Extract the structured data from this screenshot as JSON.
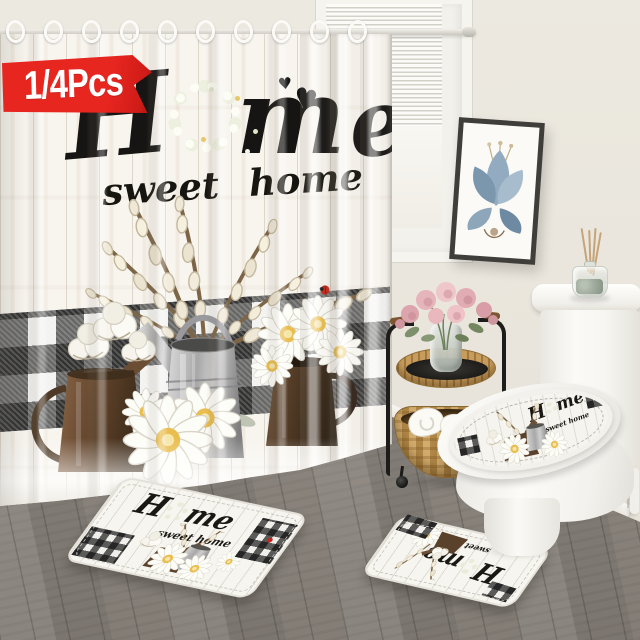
{
  "badge": {
    "label": "1/4Pcs"
  },
  "curtain": {
    "letter_h": "H",
    "letter_m": "m",
    "letter_e": "e",
    "heart": "♥",
    "subtitle_word1": "sweet",
    "subtitle_word2": "home"
  },
  "bath_mat": {
    "word_start": "H",
    "word_end": "me",
    "subtitle": "sweet home"
  },
  "contour_mat": {
    "word_start": "H",
    "word_end": "me",
    "subtitle": "sweet home"
  },
  "lid_cover": {
    "word_start": "H",
    "word_end": "me",
    "subtitle": "sweet home"
  },
  "colors": {
    "badge_red": "#e82620",
    "wall": "#e9e5dc",
    "floor_gray": "#8f8983",
    "plaid_black": "#161616",
    "curtain_white": "#f8f5ef",
    "wicker_tan": "#c59a55",
    "art_leaf_blue": "#8fa8bf",
    "rose_pink": "#e6b5bb",
    "metal_can_gray": "#a8a8a8",
    "rust_can_brown": "#46321f",
    "copper_can_brown": "#5c4028"
  }
}
